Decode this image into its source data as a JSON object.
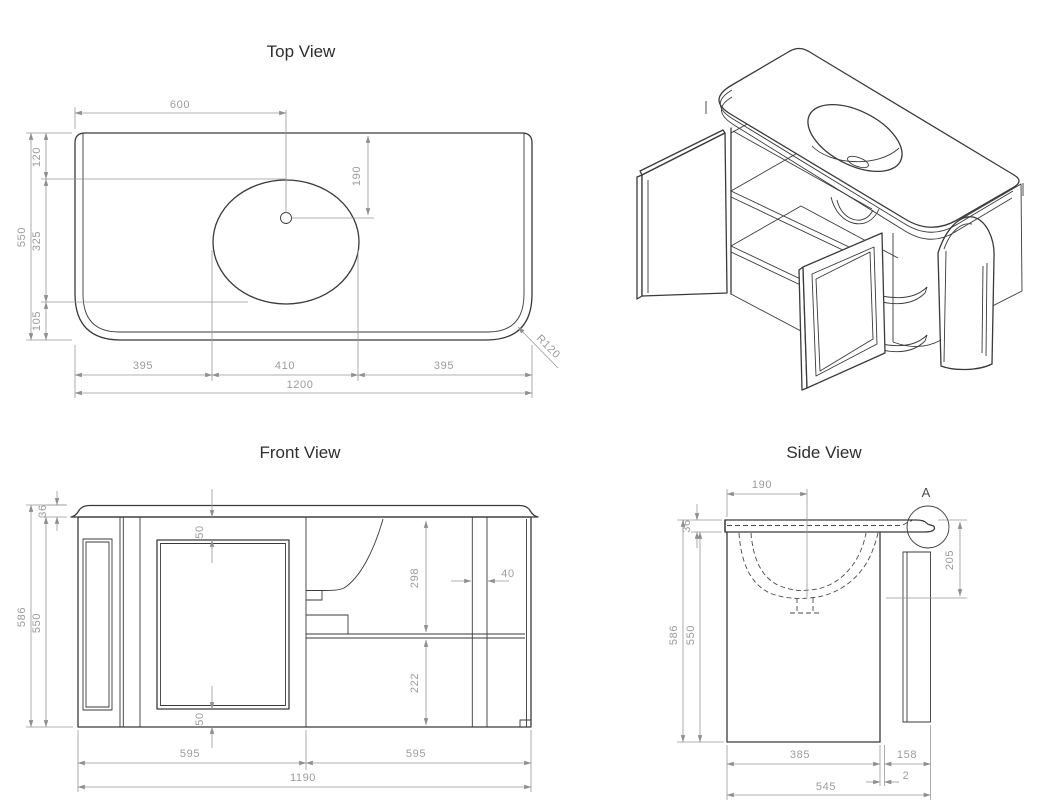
{
  "views": {
    "top": {
      "title": "Top View",
      "dims": {
        "center_x": "600",
        "basin_y": "190",
        "back": "120",
        "depth": "550",
        "mid": "325",
        "front": "105",
        "seg_left": "395",
        "seg_mid": "410",
        "seg_right": "395",
        "width": "1200",
        "radius": "R120"
      }
    },
    "front": {
      "title": "Front View",
      "dims": {
        "top_thickness": "36",
        "height": "586",
        "body_height": "550",
        "gap_top": "50",
        "gap_bottom": "50",
        "upper": "298",
        "divider": "40",
        "lower": "222",
        "seg_left": "595",
        "seg_right": "595",
        "width": "1190"
      }
    },
    "side": {
      "title": "Side View",
      "detail_label": "A",
      "dims": {
        "basin_center": "190",
        "top_thickness": "36",
        "height": "586",
        "body_height": "550",
        "basin_depth": "205",
        "body_depth": "385",
        "door_zone": "158",
        "gap": "2",
        "depth": "545"
      }
    }
  },
  "colors": {
    "line": "#3a3a3a",
    "dim_line": "#979797",
    "dim_text": "#9c9c9c",
    "title_text": "#2e2e2e",
    "background": "#ffffff"
  }
}
